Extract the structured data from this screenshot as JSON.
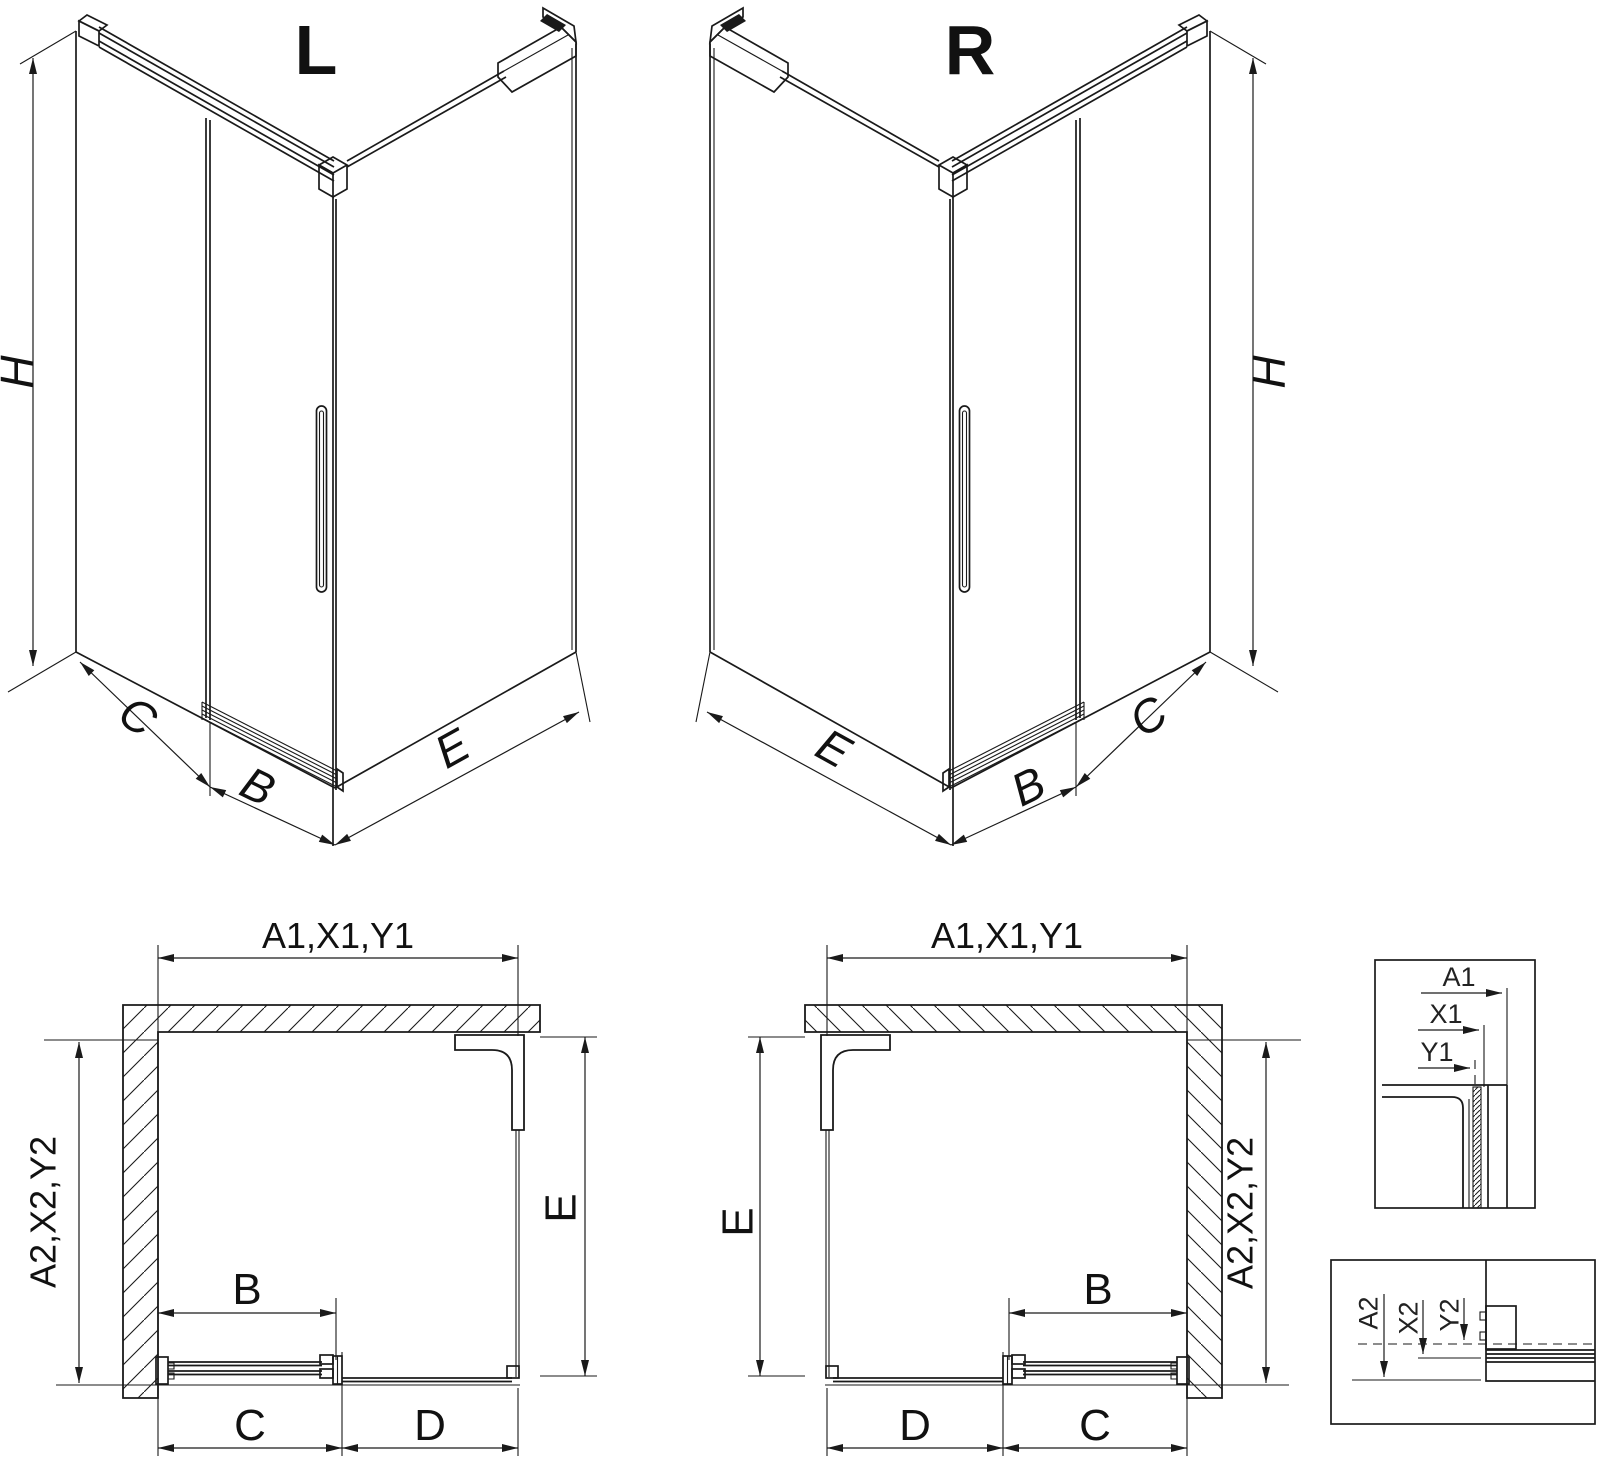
{
  "page": {
    "background": "#ffffff",
    "ink": "#1a1a1a"
  },
  "views": {
    "iso_left": {
      "title": "L",
      "dim_height": "H",
      "dim_return_panel": "C",
      "dim_door": "B",
      "dim_side_panel": "E"
    },
    "iso_right": {
      "title": "R",
      "dim_height": "H",
      "dim_side_panel": "E",
      "dim_door": "B",
      "dim_return_panel": "C"
    },
    "plan_left": {
      "dim_width": "A1,X1,Y1",
      "dim_depth": "A2,X2,Y2",
      "dim_side_panel": "E",
      "dim_door": "B",
      "dim_door_zone": "C",
      "dim_fixed_zone": "D"
    },
    "plan_right": {
      "dim_width": "A1,X1,Y1",
      "dim_depth": "A2,X2,Y2",
      "dim_side_panel": "E",
      "dim_door": "B",
      "dim_fixed_zone": "D",
      "dim_door_zone": "C"
    },
    "detail_width": {
      "dim_outer": "A1",
      "dim_mid": "X1",
      "dim_inner": "Y1"
    },
    "detail_depth": {
      "dim_outer": "A2",
      "dim_mid": "X2",
      "dim_inner": "Y2"
    }
  }
}
